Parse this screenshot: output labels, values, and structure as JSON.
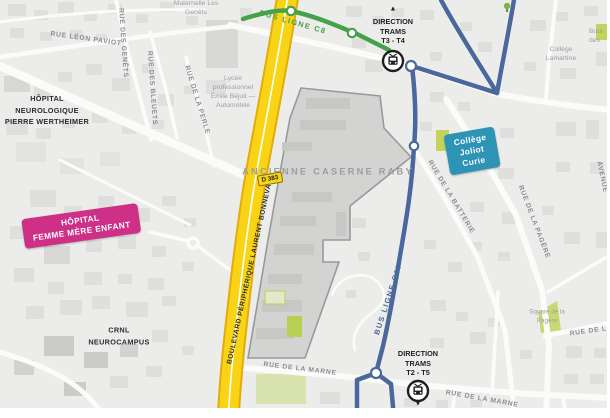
{
  "transit": {
    "bus_line_c8_label": "BUS LIGNE C8",
    "bus_line_c17_label": "BUS LIGNE C17",
    "direction_top": "DIRECTION\nTRAMS\nT3 - T4",
    "direction_bottom": "DIRECTION\nTRAMS\nT2 - T5",
    "arrow_up": "▲",
    "arrow_down": "▼"
  },
  "places": {
    "hopital_neurologique": "HÔPITAL\nNEUROLOGIQUE\nPIERRE WERTHEIMER",
    "hopital_femme_mere_enfant": "HÔPITAL\nFEMME MÈRE ENFANT",
    "crnl": "CRNL\nNEUROCAMPUS",
    "ancienne_caserne": "ANCIENNE\nCASERNE RABY",
    "college_joliot_curie": "Collège\nJoliot\nCurie",
    "college_lamartine": "Collège\nLamartine",
    "lycee": "Lycée\nprofessionnel\nÉmile Béjuit —\nAutomobile",
    "maternelle": "Maternelle Les\nGenêts",
    "square_pagere": "Square de la\nPagère",
    "boulodrome_partial": "Boul\ndes"
  },
  "streets": {
    "leon_paviot": "RUE LÉON PAVIOT",
    "des_genets": "RUE DES GENÊTS",
    "des_bleuets": "RUE DES BLEUETS",
    "de_la_perle": "RUE DE LA PERLE",
    "de_la_batterie": "RUE DE LA BATTERIE",
    "de_la_pagere": "RUE DE LA PAGÈRE",
    "de_la_marne_west": "RUE DE LA MARNE",
    "de_la_marne_east": "RUE DE LA MARNE",
    "de_la_partial": "RUE DE LA",
    "avenue_partial": "AVENUE",
    "boulevard_peripherique": "BOULEVARD PÉRIPHÉRIQUE LAURENT BONNEVAY",
    "d383": "D 383"
  },
  "colors": {
    "bus_c8": "#46a14b",
    "bus_c17": "#4a689b",
    "highway_fill": "#f8d316",
    "highway_casing": "#e3ac08",
    "banner_pink": "#ce3087",
    "banner_teal": "#2e94b6",
    "caserne_fill": "#d3d4d2",
    "caserne_border": "#98999a"
  }
}
